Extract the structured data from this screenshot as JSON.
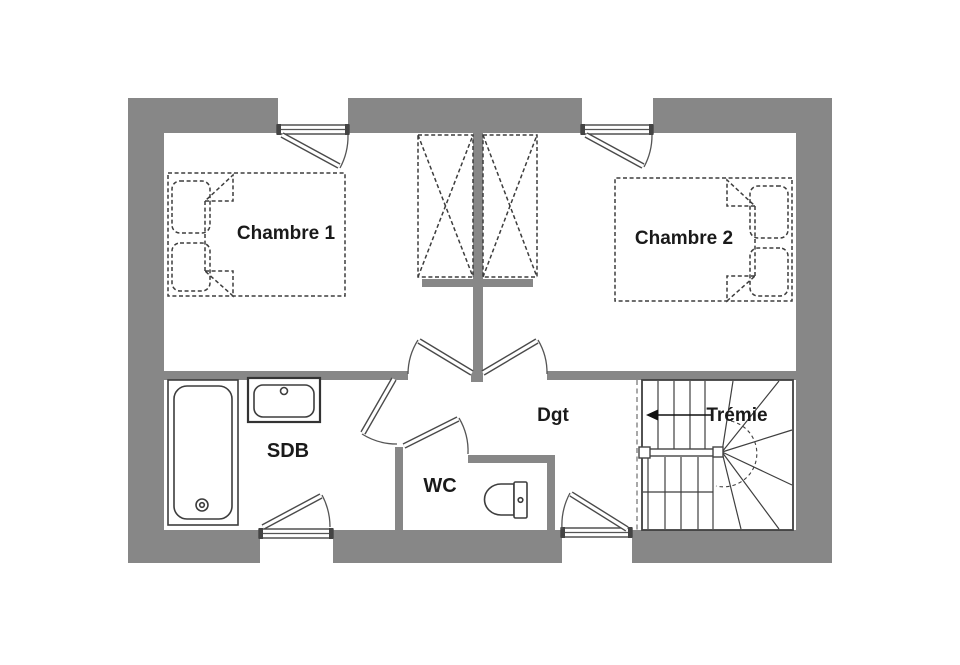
{
  "colors": {
    "wall": "#878787",
    "furniture_line": "#3d3d3d",
    "text": "#1a1a1a",
    "background": "#ffffff"
  },
  "rooms": {
    "chambre1": {
      "label": "Chambre 1"
    },
    "chambre2": {
      "label": "Chambre 2"
    },
    "sdb": {
      "label": "SDB"
    },
    "wc": {
      "label": "WC"
    },
    "dgt": {
      "label": "Dgt"
    },
    "tremie": {
      "label": "Trémie"
    }
  }
}
